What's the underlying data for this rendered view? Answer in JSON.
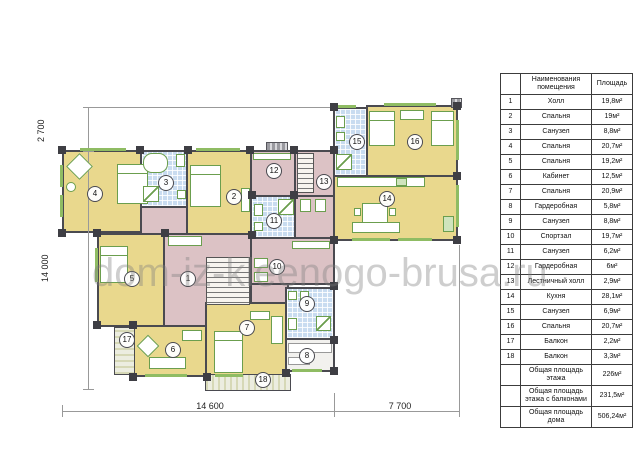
{
  "watermark": "dom-iz-kleenogo-brusa.ru",
  "dimensions": {
    "left_top": "2 700",
    "left_main": "14 000",
    "bottom_main": "14 600",
    "bottom_wing": "7 700"
  },
  "plan": {
    "labels": {
      "r1": "1",
      "r2": "2",
      "r3": "3",
      "r4": "4",
      "r5": "5",
      "r6": "6",
      "r7": "7",
      "r8": "8",
      "r9": "9",
      "r10": "10",
      "r11": "11",
      "r12": "12",
      "r13": "13",
      "r14": "14",
      "r15": "15",
      "r16": "16",
      "r17": "17",
      "r18": "18"
    },
    "colors": {
      "bedroom": "#e9d88d",
      "hall": "#dcc2c5",
      "bathroom": "#c9dcf0",
      "balcony": "#ecede0",
      "wall": "#4a4a50",
      "furniture_outline": "#6b9e4e",
      "window": "#8fbc63"
    }
  },
  "table": {
    "headers": {
      "num": "",
      "name": "Наименования помещения",
      "area": "Площадь"
    },
    "rows": [
      {
        "num": "1",
        "name": "Холл",
        "area": "19,8м²"
      },
      {
        "num": "2",
        "name": "Спальня",
        "area": "19м²"
      },
      {
        "num": "3",
        "name": "Санузел",
        "area": "8,8м²"
      },
      {
        "num": "4",
        "name": "Спальня",
        "area": "20,7м²"
      },
      {
        "num": "5",
        "name": "Спальня",
        "area": "19,2м²"
      },
      {
        "num": "6",
        "name": "Кабинет",
        "area": "12,5м²"
      },
      {
        "num": "7",
        "name": "Спальня",
        "area": "20,9м²"
      },
      {
        "num": "8",
        "name": "Гардеробная",
        "area": "5,8м²"
      },
      {
        "num": "9",
        "name": "Санузел",
        "area": "8,8м²"
      },
      {
        "num": "10",
        "name": "Спортзал",
        "area": "19,7м²"
      },
      {
        "num": "11",
        "name": "Санузел",
        "area": "6,2м²"
      },
      {
        "num": "12",
        "name": "Гардеробная",
        "area": "6м²"
      },
      {
        "num": "13",
        "name": "Лестничный холл",
        "area": "2,9м²"
      },
      {
        "num": "14",
        "name": "Кухня",
        "area": "28,1м²"
      },
      {
        "num": "15",
        "name": "Санузел",
        "area": "6,9м²"
      },
      {
        "num": "16",
        "name": "Спальня",
        "area": "20,7м²"
      },
      {
        "num": "17",
        "name": "Балкон",
        "area": "2,2м²"
      },
      {
        "num": "18",
        "name": "Балкон",
        "area": "3,3м²"
      }
    ],
    "totals": [
      {
        "name": "Общая площадь этажа",
        "area": "226м²"
      },
      {
        "name": "Общая площадь этажа с балконами",
        "area": "231,5м²"
      },
      {
        "name": "Общая площадь дома",
        "area": "506,24м²"
      }
    ]
  }
}
